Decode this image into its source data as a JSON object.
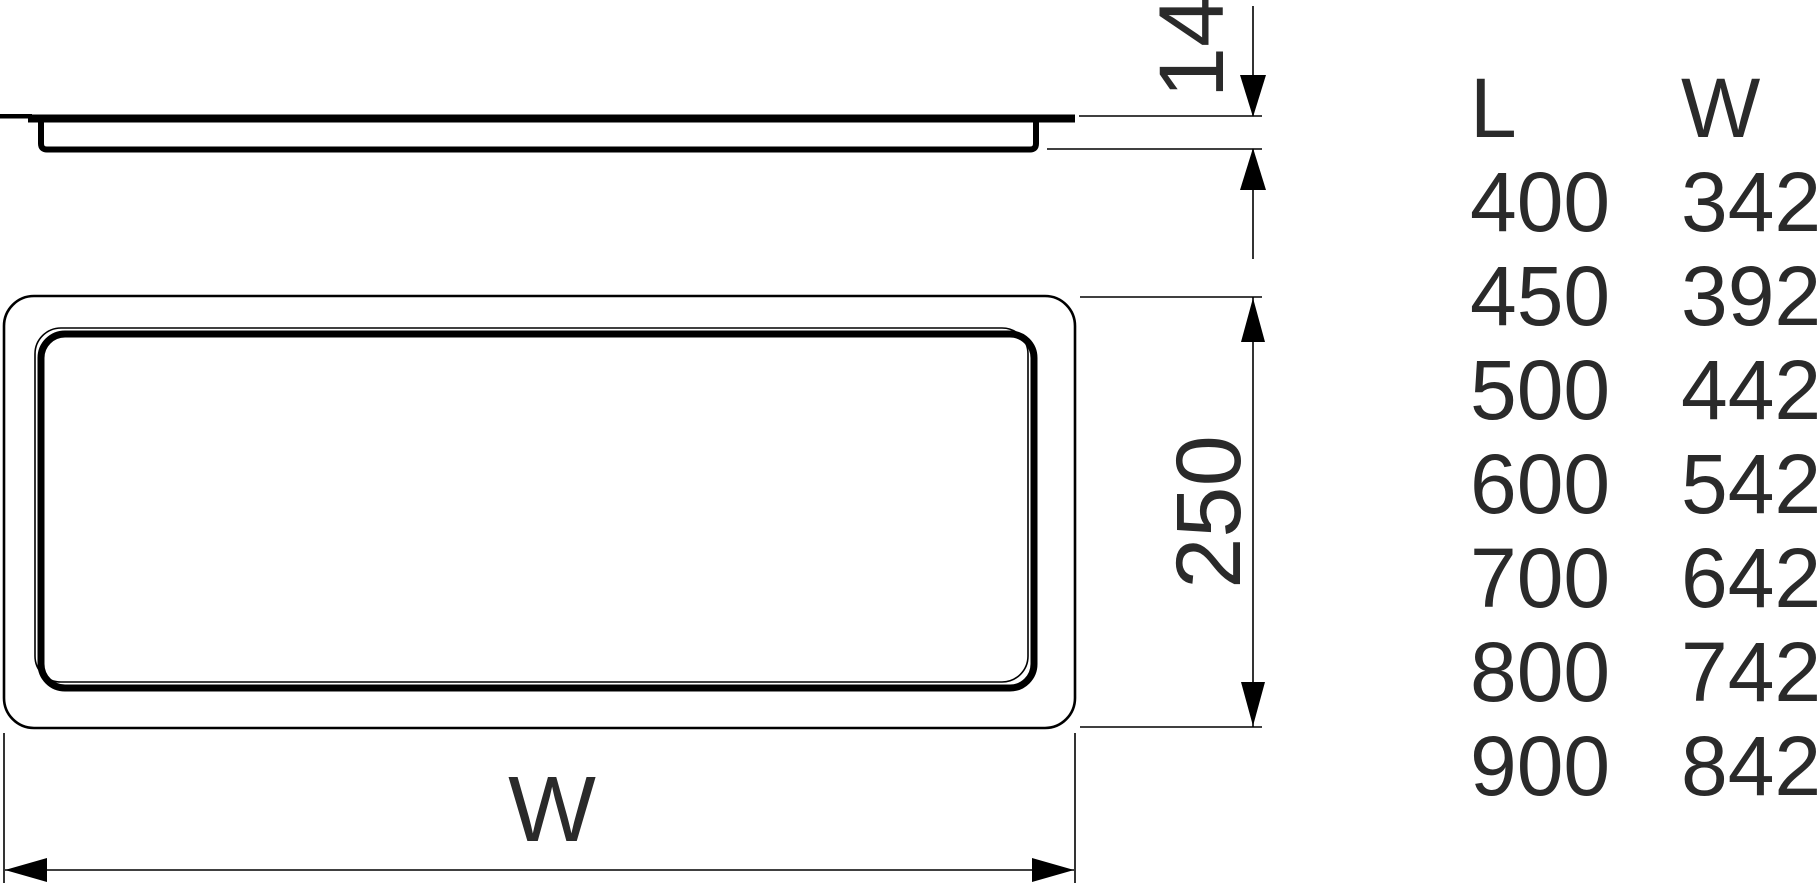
{
  "drawing": {
    "thickness_label": "14",
    "depth_label": "250",
    "width_label": "W"
  },
  "size_table": {
    "col_l_header": "L",
    "col_w_header": "W",
    "rows": [
      {
        "l": "400",
        "w": "342"
      },
      {
        "l": "450",
        "w": "392"
      },
      {
        "l": "500",
        "w": "442"
      },
      {
        "l": "600",
        "w": "542"
      },
      {
        "l": "700",
        "w": "642"
      },
      {
        "l": "800",
        "w": "742"
      },
      {
        "l": "900",
        "w": "842"
      }
    ]
  },
  "colors": {
    "line": "#000000",
    "text": "#2a2a2a",
    "background": "#ffffff"
  }
}
